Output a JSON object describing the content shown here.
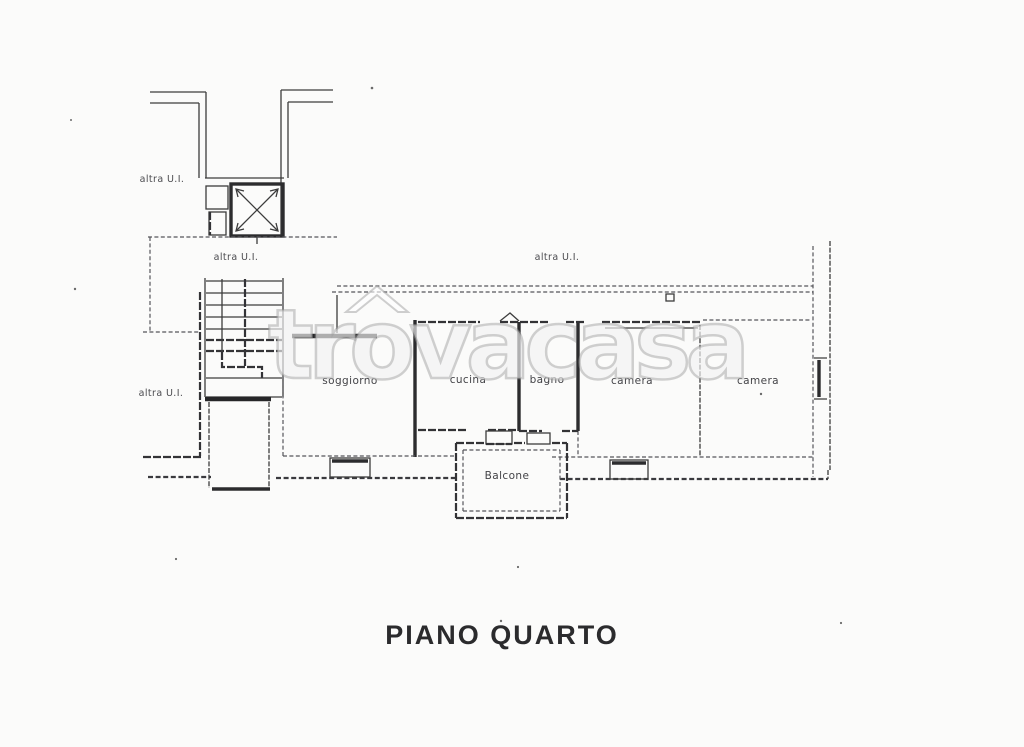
{
  "title": "PIANO QUARTO",
  "watermark": "trovacasa",
  "colors": {
    "ink": "#3a3a3a",
    "background": "#fbfbfa",
    "watermark_outline": "#9e9e9e"
  },
  "labels": {
    "altra_ui_top_left": "altra U.I.",
    "altra_ui_stairwell": "altra U.I.",
    "altra_ui_bottom_left": "altra U.I.",
    "altra_ui_terrace": "altra U.I.",
    "soggiorno": "soggiorno",
    "cucina": "cucina",
    "bagno": "bagno",
    "camera_1": "camera",
    "camera_2": "camera",
    "balcone": "Balcone"
  }
}
